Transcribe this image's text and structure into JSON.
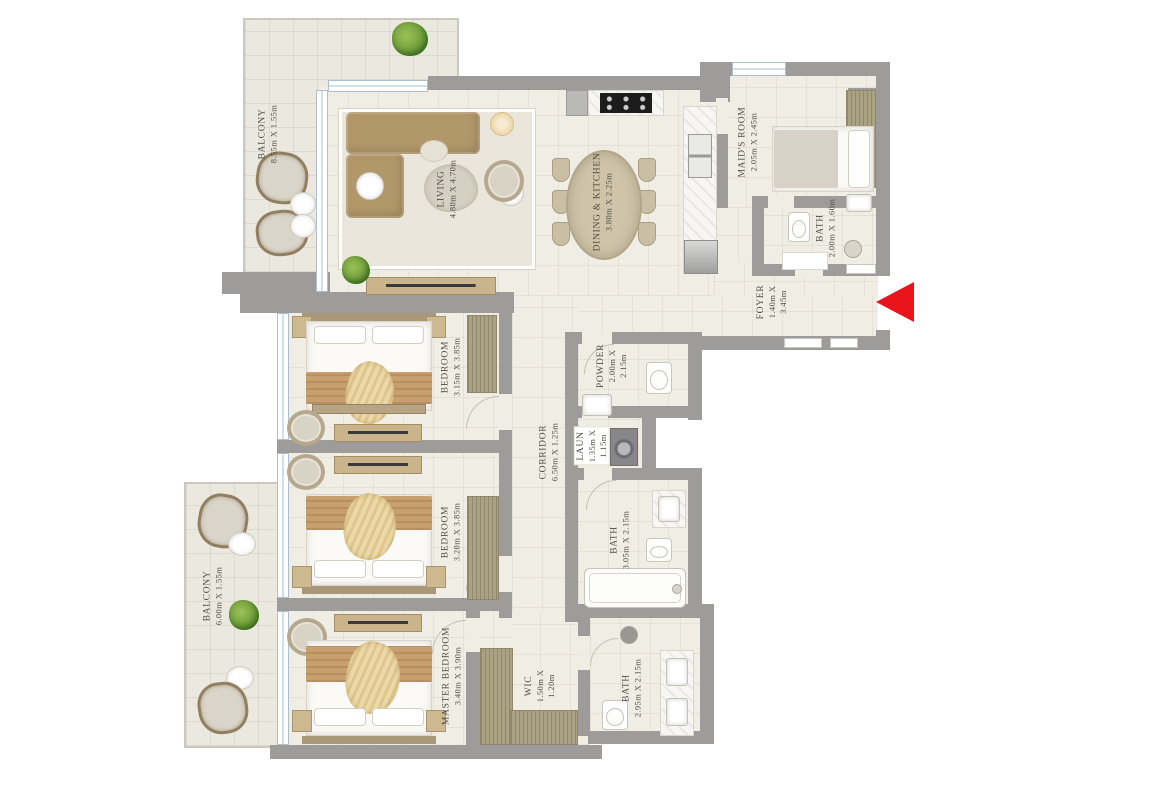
{
  "plan": {
    "colors": {
      "wall": "#9d9c9a",
      "floor": "#f0ede5",
      "balcony_floor": "#ebe8e0",
      "label_text": "#4f4e45",
      "entry_arrow": "#e8141c"
    },
    "entry_marker": {
      "shape": "triangle",
      "direction": "left"
    },
    "rooms": [
      {
        "id": "balcony-top",
        "name": "BALCONY",
        "dims": "8.55m X 1.55m"
      },
      {
        "id": "living",
        "name": "LIVING",
        "dims": "4.80m X 4.70m"
      },
      {
        "id": "dining-kitchen",
        "name": "DINING & KITCHEN",
        "dims": "3.80m X 2.25m"
      },
      {
        "id": "maids-room",
        "name": "MAID'S ROOM",
        "dims": "2.05m X 2.45m"
      },
      {
        "id": "maid-bath",
        "name": "BATH",
        "dims": "2.00m X 1.60m"
      },
      {
        "id": "foyer",
        "name": "FOYER",
        "dims": "1.40m X\n3.45m"
      },
      {
        "id": "bedroom-1",
        "name": "BEDROOM",
        "dims": "3.15m X 3.85m"
      },
      {
        "id": "corridor",
        "name": "CORRIDOR",
        "dims": "6.50m X 1.25m"
      },
      {
        "id": "powder",
        "name": "POWDER",
        "dims": "2.00m X\n2.15m"
      },
      {
        "id": "laundry",
        "name": "LAUN",
        "dims": "1.35m X\n1.15m"
      },
      {
        "id": "bedroom-2",
        "name": "BEDROOM",
        "dims": "3.20m X 3.85m"
      },
      {
        "id": "bath-shared",
        "name": "BATH",
        "dims": "3.05m X 2.15m"
      },
      {
        "id": "balcony-bottom",
        "name": "BALCONY",
        "dims": "6.00m X 1.55m"
      },
      {
        "id": "master-bedroom",
        "name": "MASTER BEDROOM",
        "dims": "3.40m X 3.90m"
      },
      {
        "id": "wic",
        "name": "WIC",
        "dims": "1.50m X\n1.20m"
      },
      {
        "id": "master-bath",
        "name": "BATH",
        "dims": "2.95m X 2.15m"
      }
    ]
  }
}
